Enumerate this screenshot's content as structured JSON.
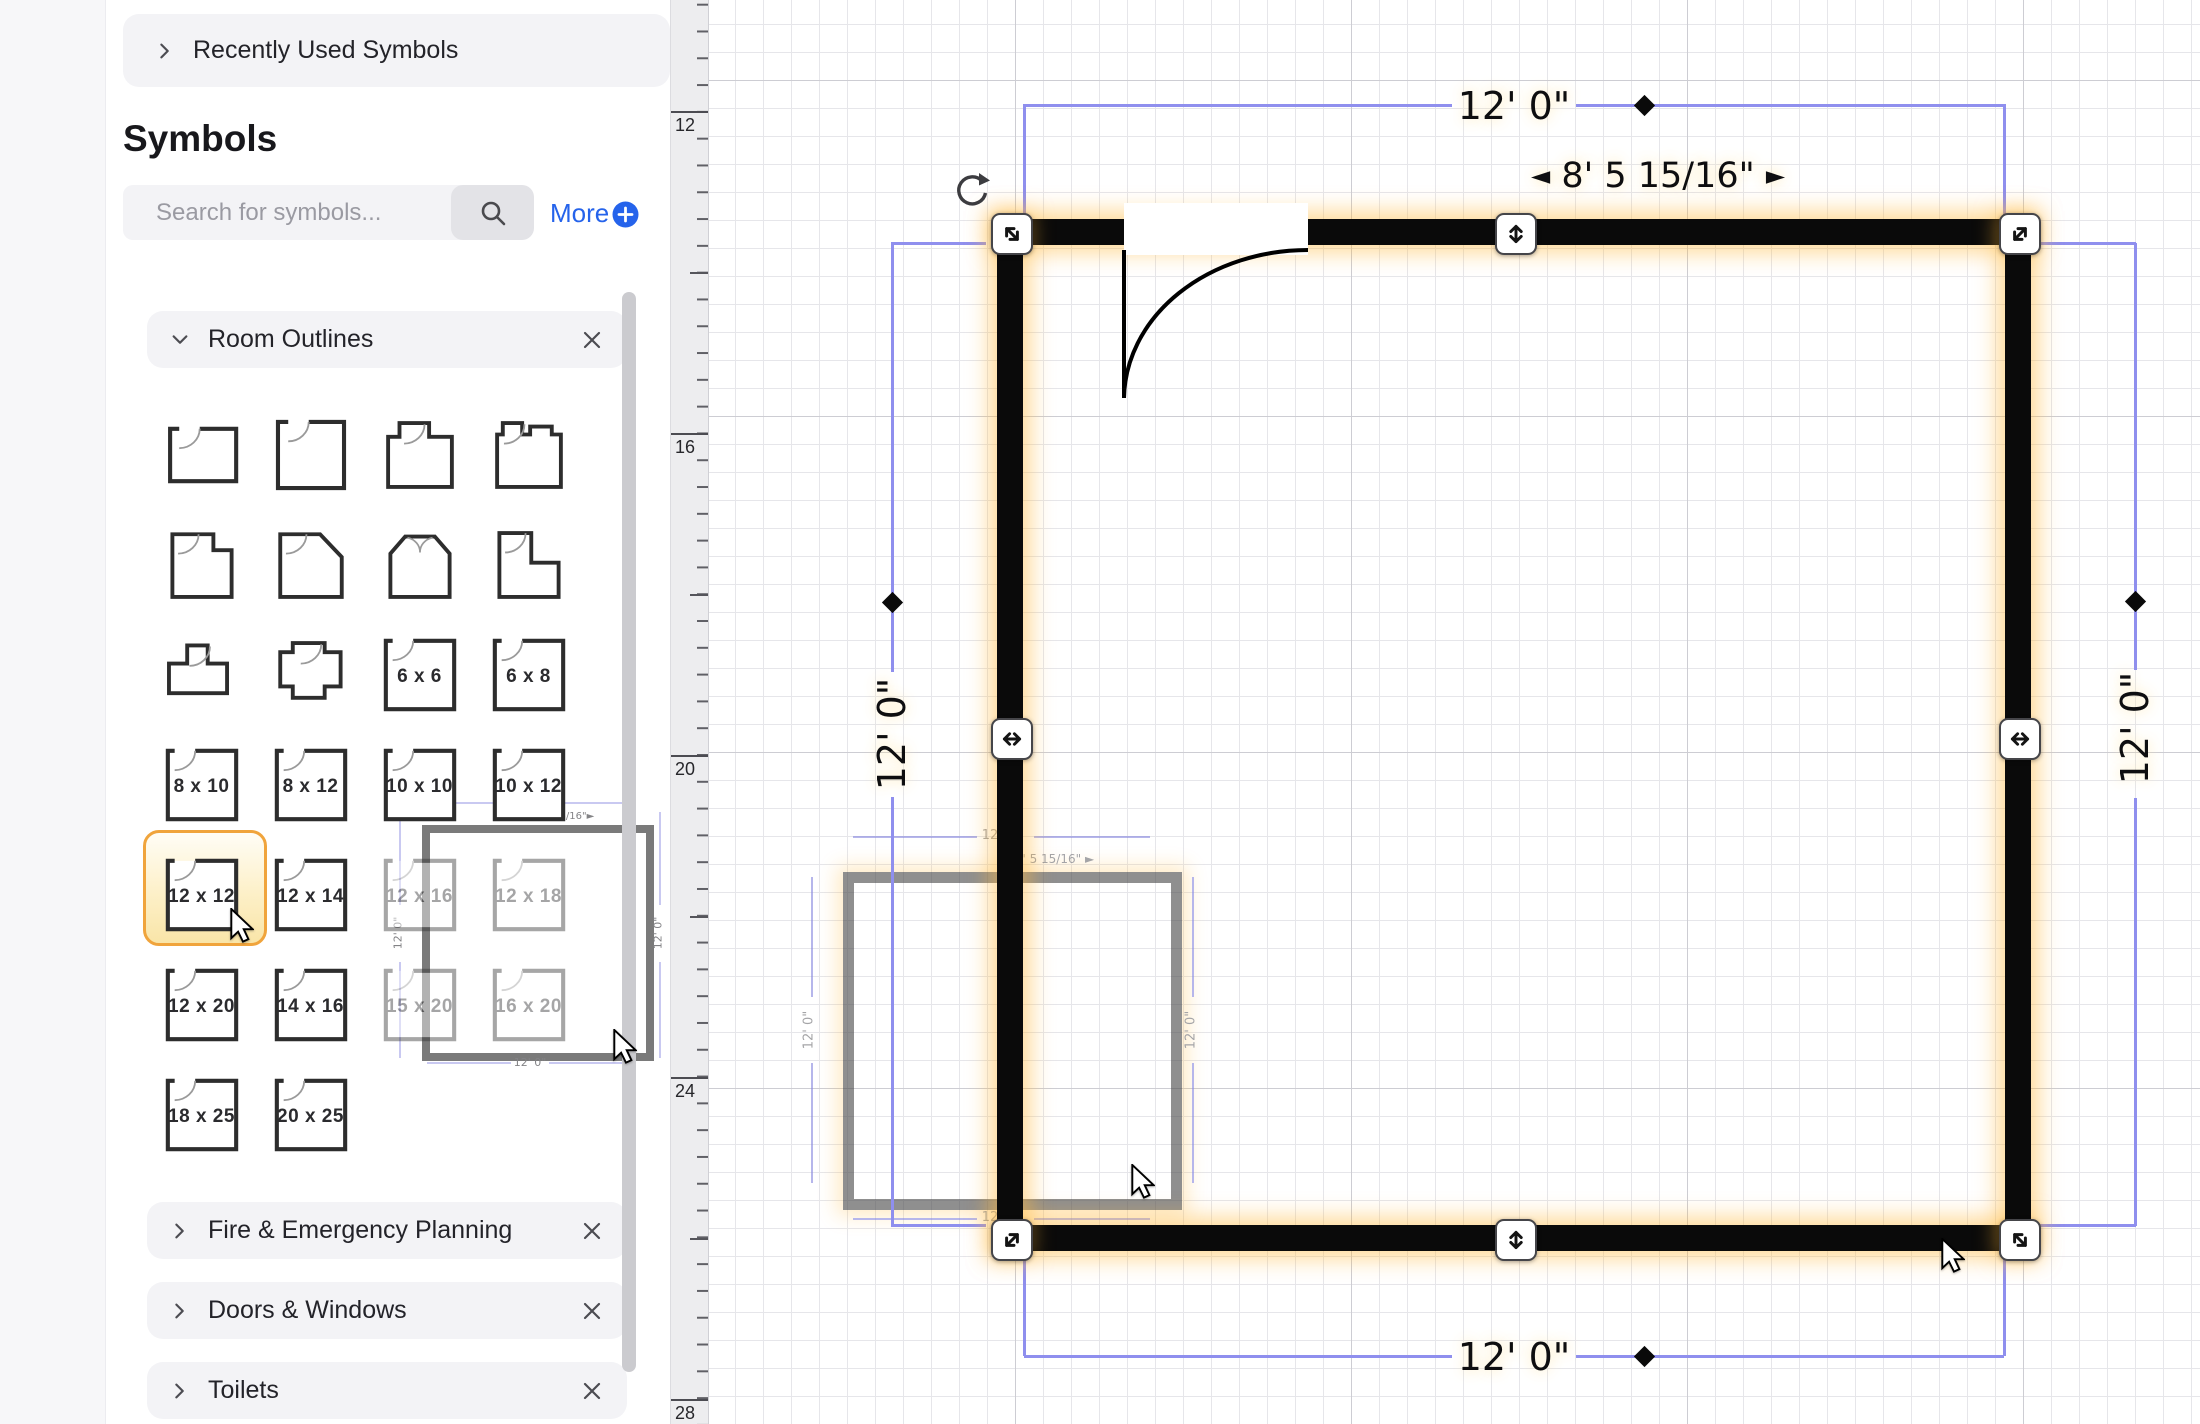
{
  "sidebar": {
    "recently_used_label": "Recently Used Symbols",
    "title": "Symbols",
    "search": {
      "placeholder": "Search for symbols...",
      "more_label": "More"
    },
    "sections": {
      "room_outlines": "Room Outlines",
      "fire": "Fire & Emergency Planning",
      "doors": "Doors & Windows",
      "toilets": "Toilets"
    },
    "sizes": [
      "6 x 6",
      "6 x 8",
      "8 x 10",
      "8 x 12",
      "10 x 10",
      "10 x 12",
      "12 x 12",
      "12 x 14",
      "12 x 16",
      "12 x 18",
      "12 x 20",
      "14 x 16",
      "15 x 20",
      "16 x 20",
      "18 x 25",
      "20 x 25"
    ],
    "selected_symbol": "12 x 12"
  },
  "canvas": {
    "ruler_numbers": [
      "12",
      "16",
      "20",
      "24",
      "28"
    ],
    "room": {
      "width_label": "12' 0\"",
      "height_label": "12' 0\"",
      "door_offset_label": "8' 5 15/16\"",
      "arrow_left": "◄",
      "arrow_right": "►"
    }
  },
  "colors": {
    "dimension_line": "#8f8fee",
    "wall": "#0a0a0a",
    "selection_glow": "#ffb838",
    "symbol_highlight": "#f0a43c",
    "accent_blue": "#2563eb"
  }
}
